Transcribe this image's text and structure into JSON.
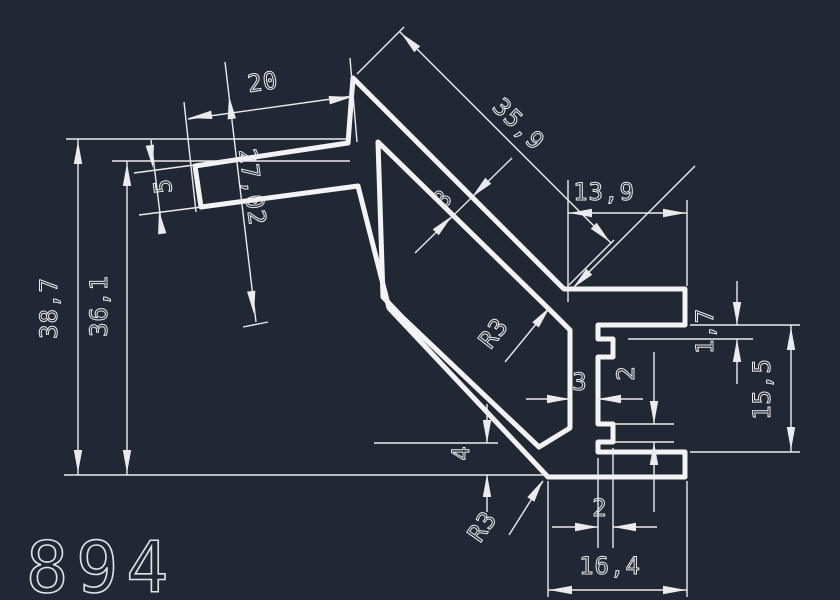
{
  "drawing": {
    "part_number": "894",
    "type": "aluminium-profile-cross-section",
    "colors": {
      "background": "#222734",
      "profile_line": "#f2f3f5",
      "dimension_line": "#e9ebee"
    },
    "dimensions": {
      "overall_height": "38,7",
      "inner_height": "36,1",
      "top_width": "20",
      "finger_width": "5",
      "finger_length": "27,02",
      "slope_length": "35,9",
      "flange_width": "13,9",
      "wall_thickness": "3",
      "inner_radius": "R3",
      "web_gap": "3",
      "tooth_height": "2",
      "lip_thickness": "1,7",
      "channel_height": "15,5",
      "base_thickness": "4",
      "outer_radius": "R3",
      "tooth_width": "2",
      "base_width": "16,4"
    }
  }
}
